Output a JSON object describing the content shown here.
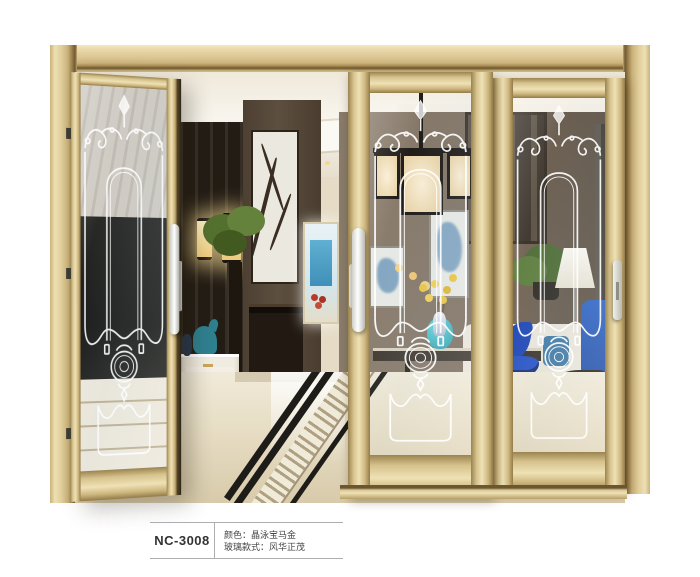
{
  "product_card": {
    "model": "NC-3008",
    "specs": [
      "颜色：晶泳宝马金",
      "玻璃款式：风华正茂"
    ]
  },
  "colors": {
    "frame_champagne_gold": "#d9c591",
    "etched_glass_white": "#ffffff",
    "accent_teal": "#3ab4be",
    "accent_cobalt": "#2150b8",
    "caption_line_gray": "#aeaeae"
  }
}
